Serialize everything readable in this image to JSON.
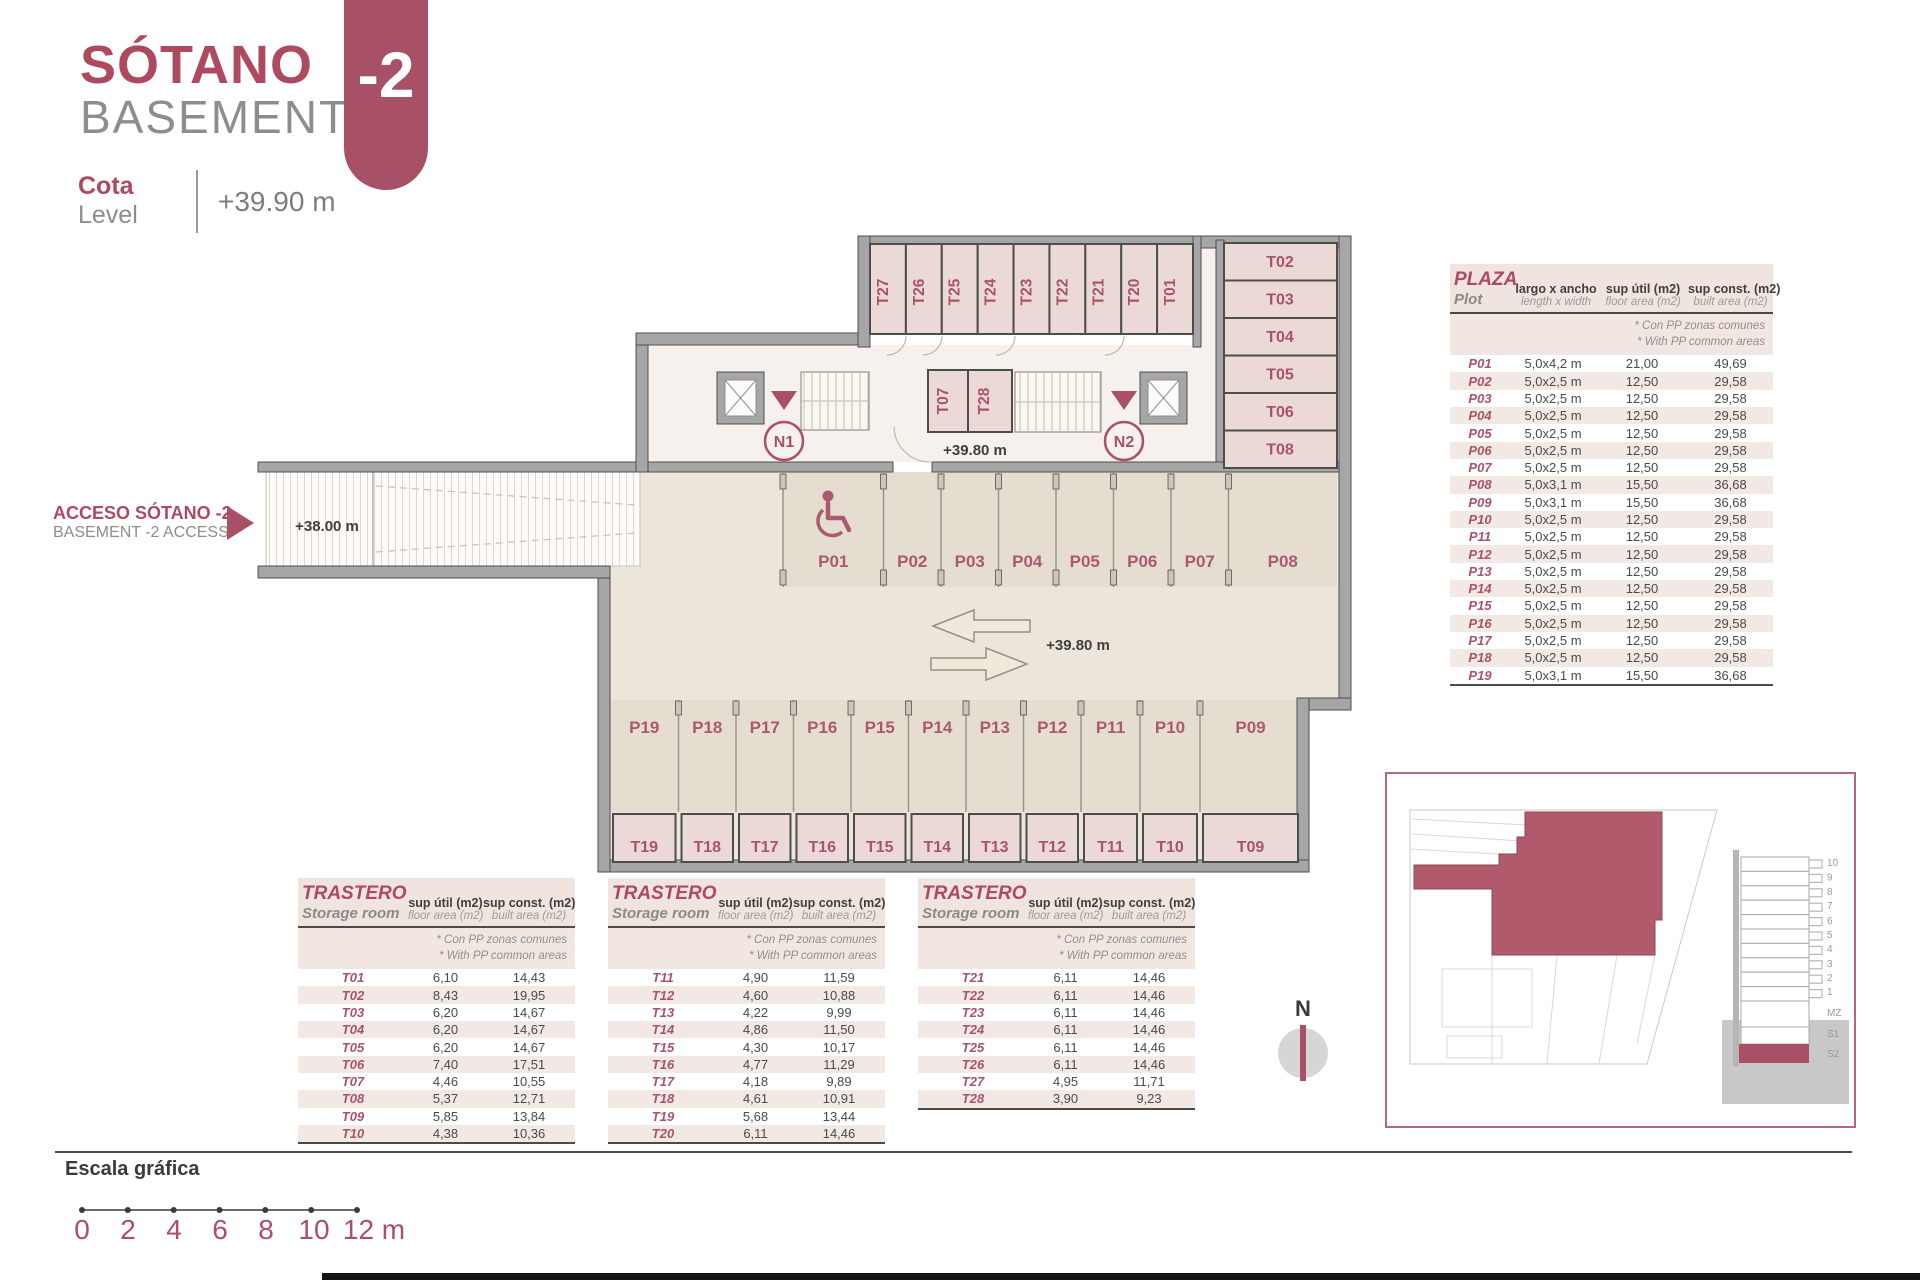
{
  "header": {
    "title_es": "SÓTANO",
    "title_en": "BASEMENT",
    "level_label_es": "Cota",
    "level_label_en": "Level",
    "level_value": "+39.90 m",
    "floor_badge": "-2"
  },
  "access": {
    "label_es": "ACCESO SÓTANO -2",
    "label_en": "BASEMENT -2 ACCESS",
    "ramp_level": "+38.00 m"
  },
  "plan": {
    "level_core": "+39.80 m",
    "level_aisle": "+39.80 m",
    "cores": [
      "N1",
      "N2"
    ],
    "top_rooms": [
      "T27",
      "T26",
      "T25",
      "T24",
      "T23",
      "T22",
      "T21",
      "T20",
      "T01"
    ],
    "right_rooms": [
      "T02",
      "T03",
      "T04",
      "T05",
      "T06",
      "T08"
    ],
    "core_rooms": [
      "T07",
      "T28"
    ],
    "parking_top": [
      "P01",
      "P02",
      "P03",
      "P04",
      "P05",
      "P06",
      "P07",
      "P08"
    ],
    "parking_bottom": [
      "P19",
      "P18",
      "P17",
      "P16",
      "P15",
      "P14",
      "P13",
      "P12",
      "P11",
      "P10",
      "P09"
    ],
    "storage_bottom": [
      "T19",
      "T18",
      "T17",
      "T16",
      "T15",
      "T14",
      "T13",
      "T12",
      "T11",
      "T10",
      "T09"
    ]
  },
  "plaza_table": {
    "title_es": "PLAZA",
    "title_en": "Plot",
    "col1_es": "largo x ancho",
    "col1_en": "length x width",
    "col2_es": "sup útil (m2)",
    "col2_en": "floor area (m2)",
    "col3_es": "sup const. (m2)",
    "col3_en": "built area (m2)",
    "note_es": "* Con PP zonas comunes",
    "note_en": "* With PP common areas",
    "rows": [
      [
        "P01",
        "5,0x4,2 m",
        "21,00",
        "49,69"
      ],
      [
        "P02",
        "5,0x2,5 m",
        "12,50",
        "29,58"
      ],
      [
        "P03",
        "5,0x2,5 m",
        "12,50",
        "29,58"
      ],
      [
        "P04",
        "5,0x2,5 m",
        "12,50",
        "29,58"
      ],
      [
        "P05",
        "5,0x2,5 m",
        "12,50",
        "29,58"
      ],
      [
        "P06",
        "5,0x2,5 m",
        "12,50",
        "29,58"
      ],
      [
        "P07",
        "5,0x2,5 m",
        "12,50",
        "29,58"
      ],
      [
        "P08",
        "5,0x3,1 m",
        "15,50",
        "36,68"
      ],
      [
        "P09",
        "5,0x3,1 m",
        "15,50",
        "36,68"
      ],
      [
        "P10",
        "5,0x2,5 m",
        "12,50",
        "29,58"
      ],
      [
        "P11",
        "5,0x2,5 m",
        "12,50",
        "29,58"
      ],
      [
        "P12",
        "5,0x2,5 m",
        "12,50",
        "29,58"
      ],
      [
        "P13",
        "5,0x2,5 m",
        "12,50",
        "29,58"
      ],
      [
        "P14",
        "5,0x2,5 m",
        "12,50",
        "29,58"
      ],
      [
        "P15",
        "5,0x2,5 m",
        "12,50",
        "29,58"
      ],
      [
        "P16",
        "5,0x2,5 m",
        "12,50",
        "29,58"
      ],
      [
        "P17",
        "5,0x2,5 m",
        "12,50",
        "29,58"
      ],
      [
        "P18",
        "5,0x2,5 m",
        "12,50",
        "29,58"
      ],
      [
        "P19",
        "5,0x3,1 m",
        "15,50",
        "36,68"
      ]
    ]
  },
  "storage_tables": {
    "title_es": "TRASTERO",
    "title_en": "Storage room",
    "col_util_es": "sup útil (m2)",
    "col_util_en": "floor area (m2)",
    "col_const_es": "sup const. (m2)",
    "col_const_en": "built area (m2)",
    "note_es": "* Con PP zonas comunes",
    "note_en": "* With PP common areas",
    "t01": {
      "rows": [
        [
          "T01",
          "6,10",
          "14,43"
        ],
        [
          "T02",
          "8,43",
          "19,95"
        ],
        [
          "T03",
          "6,20",
          "14,67"
        ],
        [
          "T04",
          "6,20",
          "14,67"
        ],
        [
          "T05",
          "6,20",
          "14,67"
        ],
        [
          "T06",
          "7,40",
          "17,51"
        ],
        [
          "T07",
          "4,46",
          "10,55"
        ],
        [
          "T08",
          "5,37",
          "12,71"
        ],
        [
          "T09",
          "5,85",
          "13,84"
        ],
        [
          "T10",
          "4,38",
          "10,36"
        ]
      ]
    },
    "t11": {
      "rows": [
        [
          "T11",
          "4,90",
          "11,59"
        ],
        [
          "T12",
          "4,60",
          "10,88"
        ],
        [
          "T13",
          "4,22",
          "9,99"
        ],
        [
          "T14",
          "4,86",
          "11,50"
        ],
        [
          "T15",
          "4,30",
          "10,17"
        ],
        [
          "T16",
          "4,77",
          "11,29"
        ],
        [
          "T17",
          "4,18",
          "9,89"
        ],
        [
          "T18",
          "4,61",
          "10,91"
        ],
        [
          "T19",
          "5,68",
          "13,44"
        ],
        [
          "T20",
          "6,11",
          "14,46"
        ]
      ]
    },
    "t21": {
      "rows": [
        [
          "T21",
          "6,11",
          "14,46"
        ],
        [
          "T22",
          "6,11",
          "14,46"
        ],
        [
          "T23",
          "6,11",
          "14,46"
        ],
        [
          "T24",
          "6,11",
          "14,46"
        ],
        [
          "T25",
          "6,11",
          "14,46"
        ],
        [
          "T26",
          "6,11",
          "14,46"
        ],
        [
          "T27",
          "4,95",
          "11,71"
        ],
        [
          "T28",
          "3,90",
          "9,23"
        ]
      ]
    }
  },
  "inset": {
    "section_labels": [
      "10",
      "9",
      "8",
      "7",
      "6",
      "5",
      "4",
      "3",
      "2",
      "1",
      "MZ",
      "S1",
      "S2"
    ]
  },
  "compass": {
    "north": "N"
  },
  "scale": {
    "title": "Escala gráfica",
    "ticks": [
      "0",
      "2",
      "4",
      "6",
      "8",
      "10",
      "12 m"
    ]
  },
  "colors": {
    "brand_maroon": "#a85166",
    "label_maroon": "#a9536a",
    "text_gray": "#8d8d8d",
    "storage_fill": "#ead9d6",
    "garage_fill": "#ece6da"
  }
}
